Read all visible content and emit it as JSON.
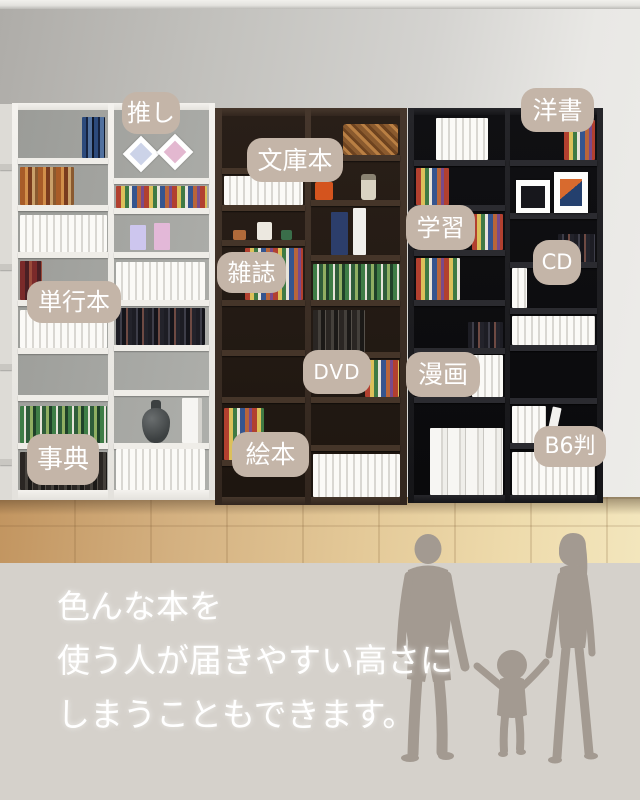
{
  "labels": [
    {
      "id": "oshi",
      "text": "推し"
    },
    {
      "id": "bunkobon",
      "text": "文庫本"
    },
    {
      "id": "yosho",
      "text": "洋書"
    },
    {
      "id": "tankobon",
      "text": "単行本"
    },
    {
      "id": "zasshi",
      "text": "雑誌"
    },
    {
      "id": "gakushu",
      "text": "学習"
    },
    {
      "id": "cd",
      "text": "CD"
    },
    {
      "id": "dvd",
      "text": "DVD"
    },
    {
      "id": "manga",
      "text": "漫画"
    },
    {
      "id": "jiten",
      "text": "事典"
    },
    {
      "id": "ehon",
      "text": "絵本"
    },
    {
      "id": "b6ban",
      "text": "B6判"
    }
  ],
  "caption": {
    "lines": [
      "色んな本を",
      "使う人が届きやすい高さに",
      "しまうこともできます。"
    ]
  },
  "colors": {
    "label_bg": "#c4b5a8",
    "label_text": "#ffffff",
    "caption_text": "#ffffff",
    "overlay_band": "#d5d1cb",
    "silhouette": "#a39a91",
    "bookcase_white": "#efede8",
    "bookcase_brown": "#3a2d24",
    "bookcase_black": "#1d1d20",
    "floor_wood": "#e3c897",
    "wall": "#c2c1bd"
  }
}
